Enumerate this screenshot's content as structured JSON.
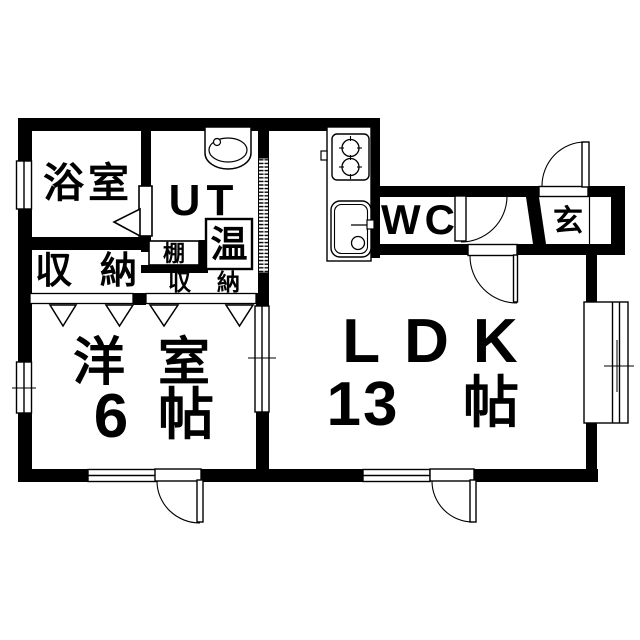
{
  "colors": {
    "background": "#ffffff",
    "line": "#000000"
  },
  "rooms": {
    "bathroom": {
      "label": "浴室"
    },
    "utility": {
      "label": "UT"
    },
    "water_heater": {
      "label": "温"
    },
    "shelf": {
      "label": "棚"
    },
    "closet_upper": {
      "label": "収納"
    },
    "closet_lower": {
      "label": "収納"
    },
    "wc": {
      "label": "WC"
    },
    "entrance": {
      "label": "玄"
    },
    "western_room": {
      "label": "洋室",
      "size_value": "6",
      "size_unit": "帖"
    },
    "ldk": {
      "label": "LDK",
      "size_value": "13",
      "size_unit": "帖"
    }
  }
}
